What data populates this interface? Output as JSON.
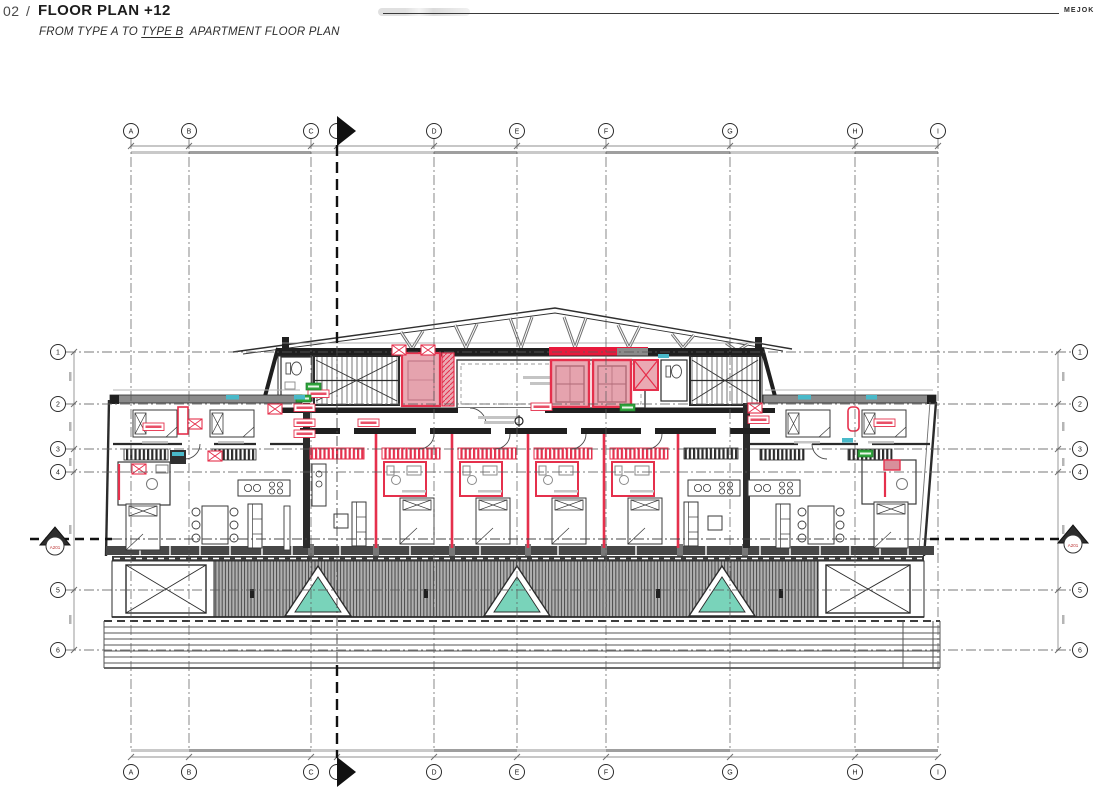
{
  "header": {
    "sheet_number": "02",
    "separator": "/",
    "title": "FLOOR PLAN +12",
    "subtitle_prefix": "FROM TYPE A TO ",
    "subtitle_underlined": "TYPE B",
    "subtitle_suffix": " APARTMENT FLOOR PLAN",
    "brand": "MEJOK"
  },
  "grid": {
    "cols": [
      "A",
      "B",
      "C",
      "D",
      "E",
      "F",
      "G",
      "H",
      "I"
    ],
    "rows": [
      "1",
      "2",
      "3",
      "4",
      "5",
      "6"
    ]
  },
  "section": {
    "reference": "A201"
  },
  "colors": {
    "highlight_red": "#e5304c",
    "highlight_pink": "#eaa9b3",
    "skylight_teal": "#79d3ba",
    "vent_cyan": "#49b9c9",
    "tag_green": "#2fa43c",
    "wall_dark": "#2b2b2b",
    "wall_gray": "#8a8a8a",
    "hatch_gray": "#b0b0b0"
  }
}
